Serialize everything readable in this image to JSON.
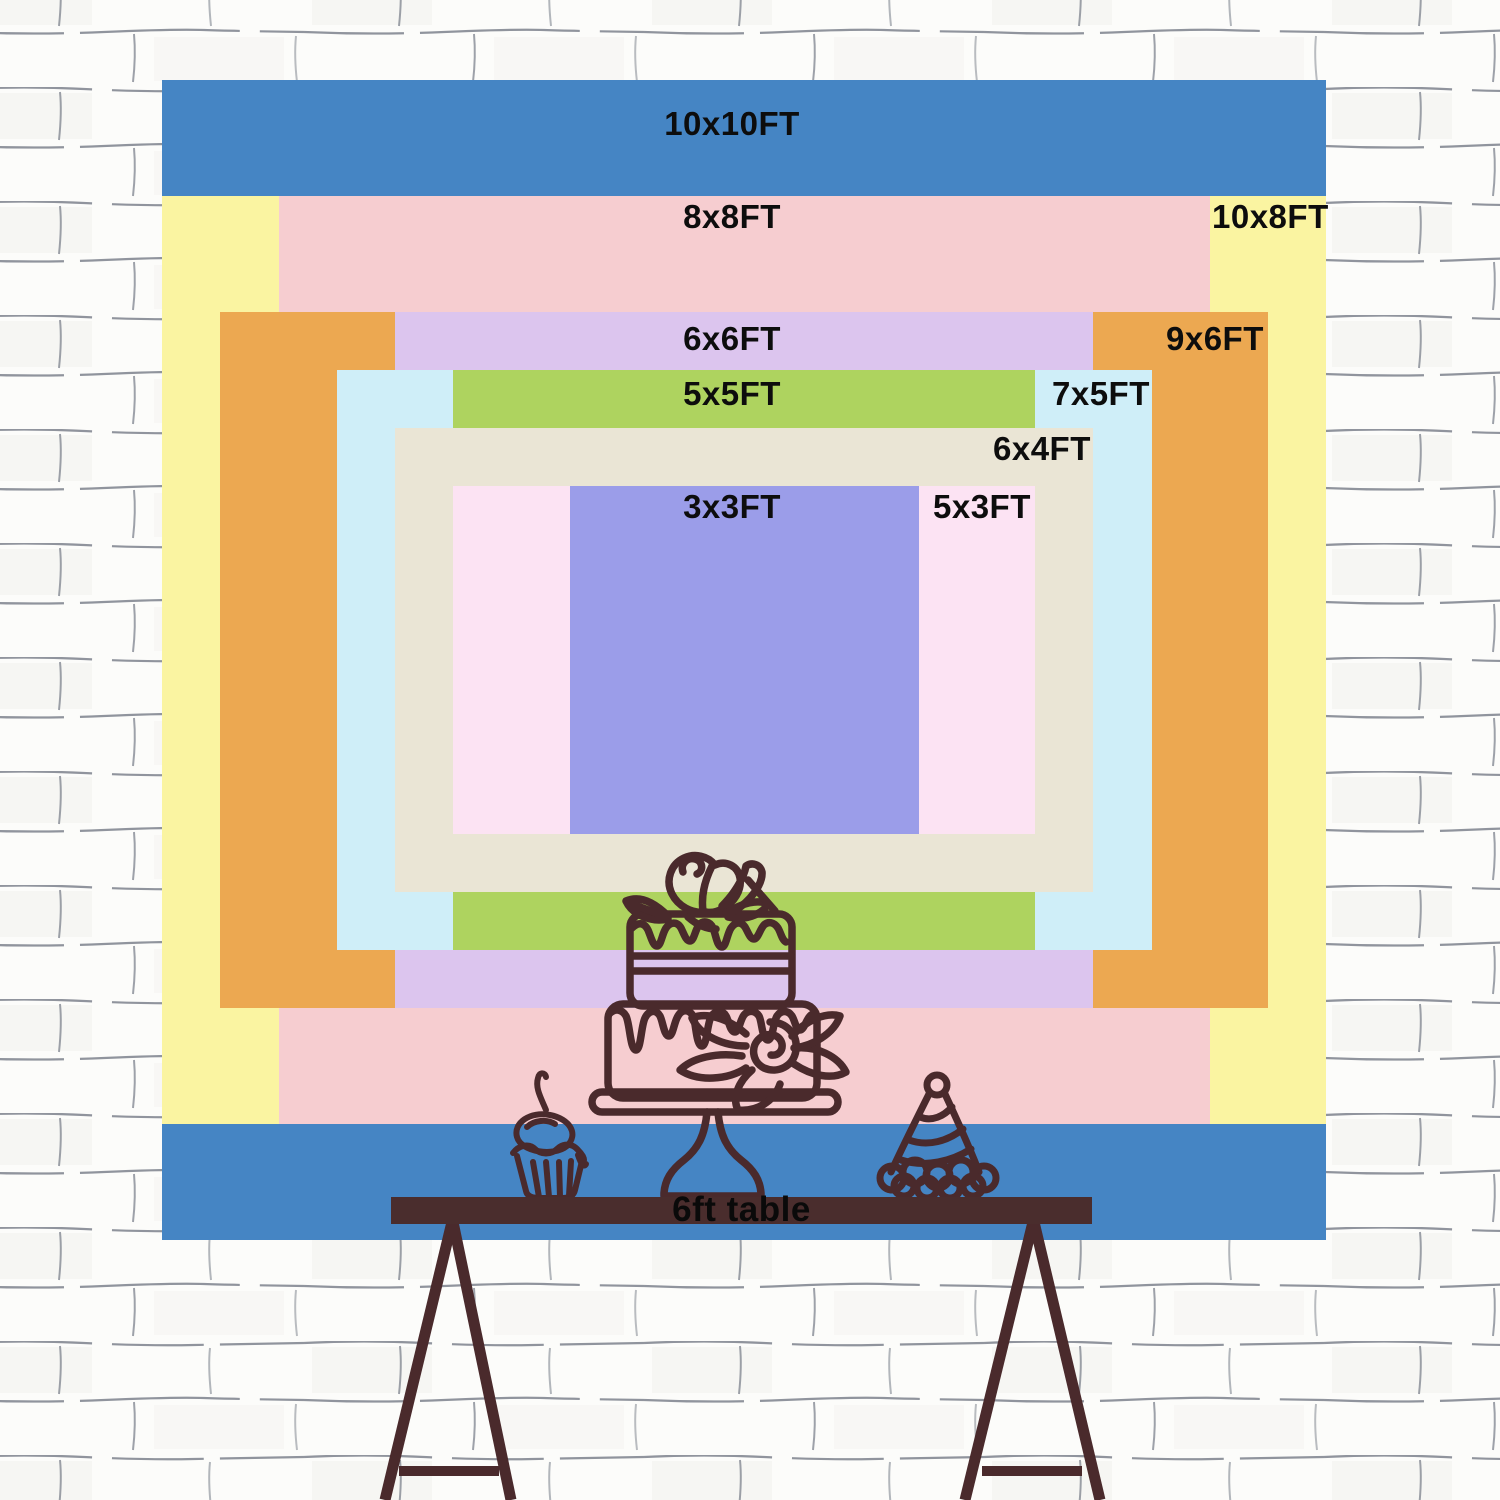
{
  "backdrop": {
    "description_note": "nested backdrop size chart",
    "sizes": [
      {
        "label": "10x10FT",
        "w_ft": 10,
        "h_ft": 10,
        "color": "#4585c4"
      },
      {
        "label": "10x8FT",
        "w_ft": 10,
        "h_ft": 8,
        "color": "#faf4a1"
      },
      {
        "label": "8x8FT",
        "w_ft": 8,
        "h_ft": 8,
        "color": "#f6cdd0"
      },
      {
        "label": "9x6FT",
        "w_ft": 9,
        "h_ft": 6,
        "color": "#eca851"
      },
      {
        "label": "6x6FT",
        "w_ft": 6,
        "h_ft": 6,
        "color": "#dcc5ee"
      },
      {
        "label": "7x5FT",
        "w_ft": 7,
        "h_ft": 5,
        "color": "#cfeef8"
      },
      {
        "label": "5x5FT",
        "w_ft": 5,
        "h_ft": 5,
        "color": "#aed35f"
      },
      {
        "label": "6x4FT",
        "w_ft": 6,
        "h_ft": 4,
        "color": "#eae5d5"
      },
      {
        "label": "5x3FT",
        "w_ft": 5,
        "h_ft": 3,
        "color": "#fce3f3"
      },
      {
        "label": "3x3FT",
        "w_ft": 3,
        "h_ft": 3,
        "color": "#9b9de9"
      }
    ]
  },
  "table": {
    "label": "6ft table",
    "color": "#4a2d2d"
  },
  "art": {
    "line_color": "#4a2a2c",
    "items": [
      "tiered-cake",
      "cupcake",
      "party-hat",
      "trestle-legs"
    ]
  },
  "wall": {
    "background": "#fcfcfa",
    "mortar_color": "#757b86"
  }
}
